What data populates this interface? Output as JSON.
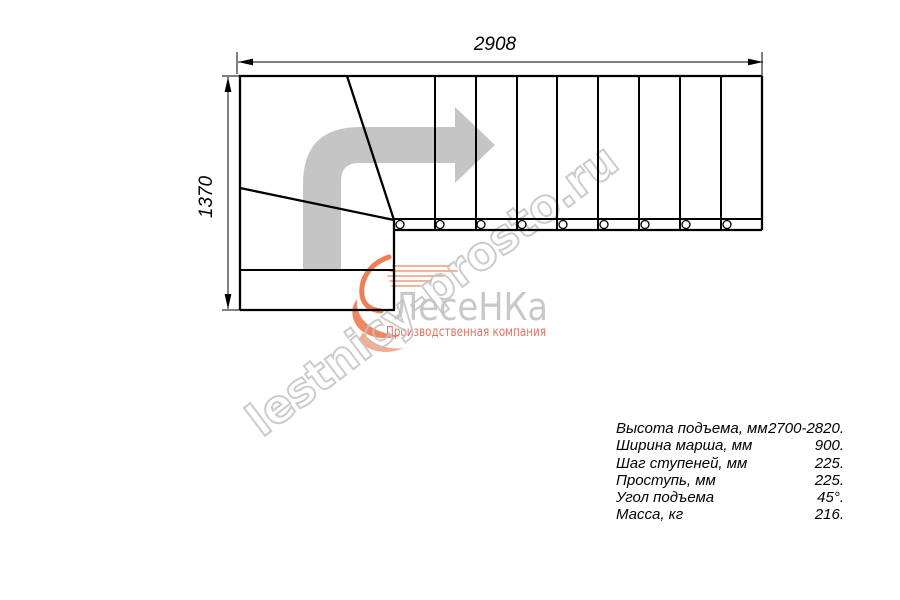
{
  "diagram": {
    "type": "staircase-plan-L-shaped",
    "width_mm": "2908",
    "depth_mm": "1370",
    "straight_tread_count": 9
  },
  "specs": {
    "rows": [
      {
        "label": "Высота подъема, мм",
        "value": "2700-2820."
      },
      {
        "label": "Ширина марша, мм",
        "value": "900."
      },
      {
        "label": "Шаг ступеней, мм",
        "value": "225."
      },
      {
        "label": "Проступь, мм",
        "value": "225."
      },
      {
        "label": "Угол подъема",
        "value": "45°."
      },
      {
        "label": "Масса, кг",
        "value": "216."
      }
    ]
  },
  "watermark": {
    "site": "lestnicy-prosto.ru",
    "logo_text": "ЛесеНКа",
    "logo_subtitle": "Производственная компания"
  },
  "colors": {
    "line_black": "#000000",
    "arrow_gray": "#c5c5c5",
    "watermark_outline_gray": "#c3c3c3",
    "logo_text_gray": "#c8c8c8",
    "logo_orange": "#ef7e57",
    "logo_orange_light": "#f5ab8d",
    "subtitle_red": "#e05a48"
  }
}
